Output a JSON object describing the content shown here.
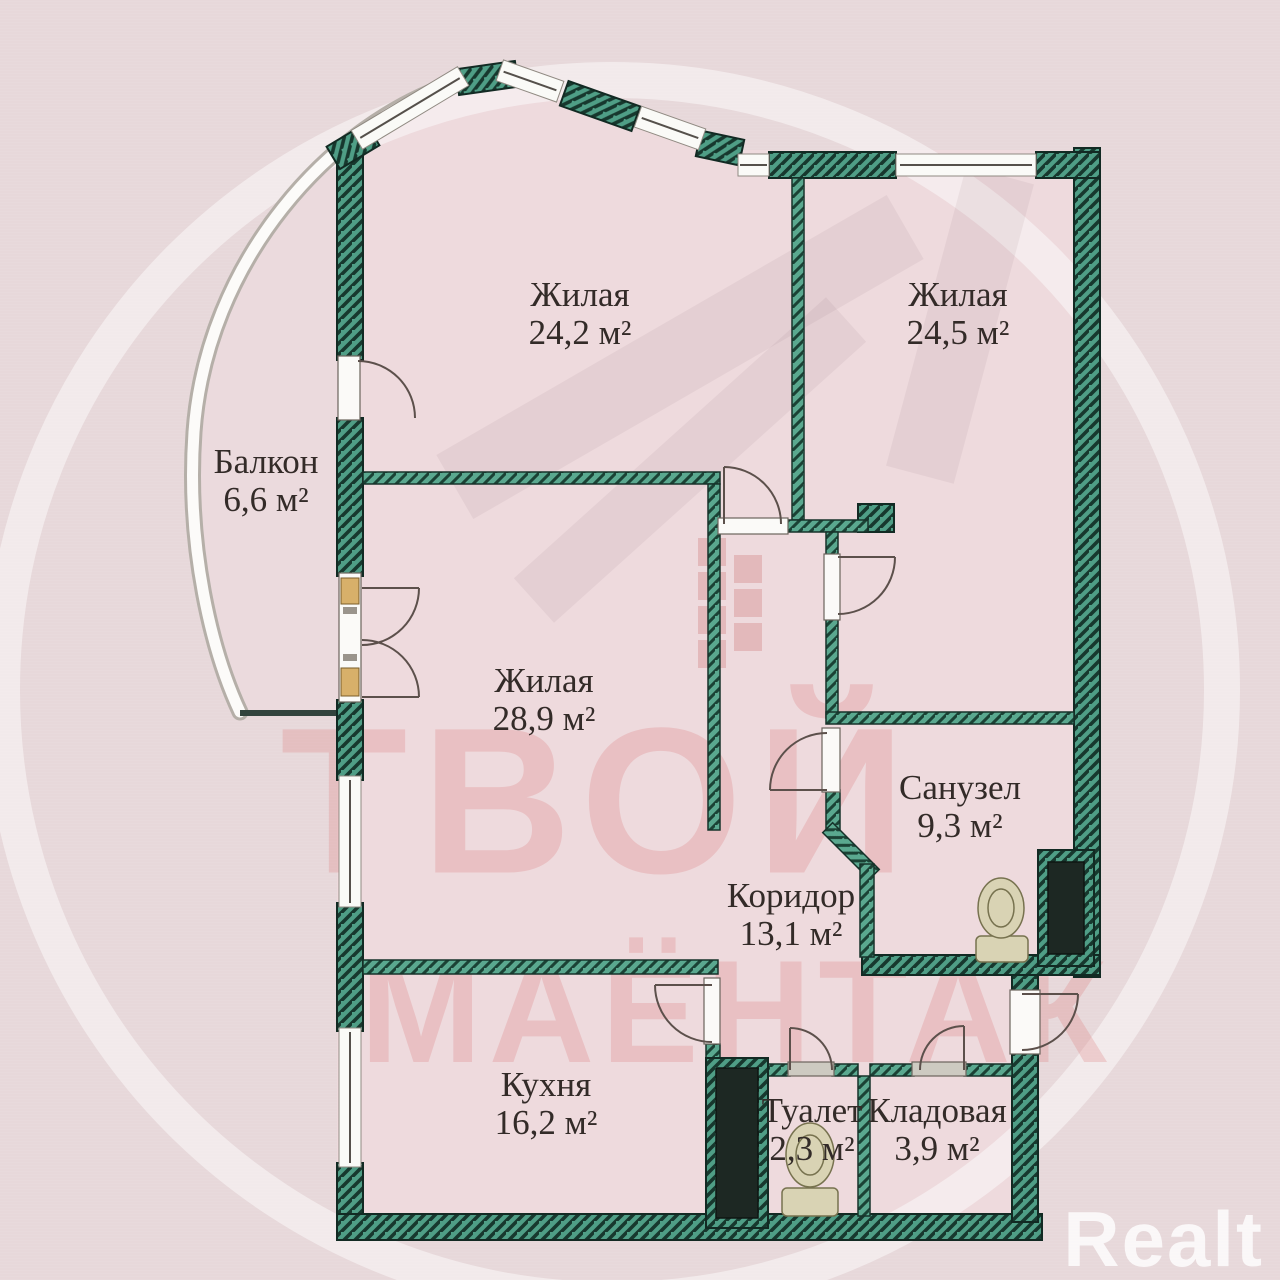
{
  "title": "Apartment floor plan",
  "watermark": {
    "line1": "ТВОЙ",
    "line2": "МАЁНТАК",
    "brand": "Realt"
  },
  "colors": {
    "background": "#e7d8da",
    "room_fill": "#eedadd",
    "wall_teal": "#4f9e86",
    "wall_hatch": "#17382e",
    "watermark_red": "#db7676",
    "brand_white": "#ffffff",
    "label_text": "#332b28"
  },
  "fixtures": {
    "bathroom_fixture": "toilet-icon",
    "wc_fixture": "toilet-icon"
  },
  "rooms": [
    {
      "id": "living1",
      "label": "Жилая",
      "area": "24,2 м²"
    },
    {
      "id": "living2",
      "label": "Жилая",
      "area": "24,5 м²"
    },
    {
      "id": "balcony",
      "label": "Балкон",
      "area": "6,6 м²"
    },
    {
      "id": "living3",
      "label": "Жилая",
      "area": "28,9 м²"
    },
    {
      "id": "bathroom",
      "label": "Санузел",
      "area": "9,3 м²"
    },
    {
      "id": "corridor",
      "label": "Коридор",
      "area": "13,1 м²"
    },
    {
      "id": "kitchen",
      "label": "Кухня",
      "area": "16,2 м²"
    },
    {
      "id": "toilet",
      "label": "Туалет",
      "area": "2,3 м²"
    },
    {
      "id": "storage",
      "label": "Кладовая",
      "area": "3,9 м²"
    }
  ]
}
